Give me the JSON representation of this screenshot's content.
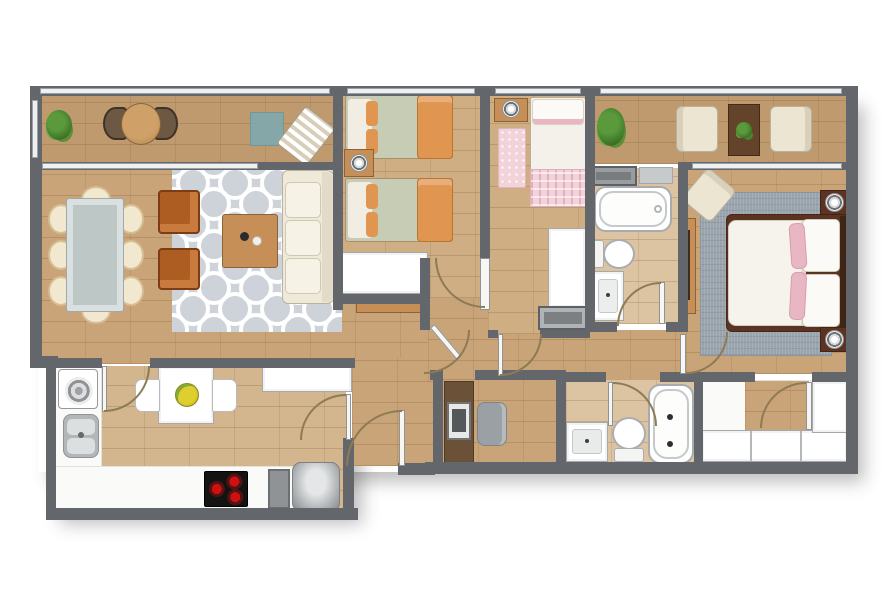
{
  "palette": {
    "wall": "#63676b",
    "wall_mid": "#8f9396",
    "window_glass": "#eef0f2",
    "window_frame": "#9aa0a4",
    "floor_living": "#c9a478",
    "floor_balcony": "#bf9a6e",
    "floor_bedroom": "#cfae84",
    "floor_bath": "#dcc4a2",
    "floor_kitchen_wood": "#d3b58e",
    "floor_white": "#fafaf8",
    "rug_trellis_bg": "#cdd3d9",
    "rug_trellis_line": "#ffffff",
    "rug_master": "#9aa4ac",
    "rug_pink": "#f3d3da",
    "sofa_cream": "#efe9d9",
    "cushion_cream": "#f6f2e6",
    "armchair_orange": "#ad5c22",
    "armchair_orange_light": "#c97a3d",
    "dining_glass": "#bcc7c6",
    "wicker": "#f2e7cf",
    "wicker_edge": "#d6bd92",
    "wood_furniture": "#c68f57",
    "wood_dark": "#8c6238",
    "bed_sage": "#c7ccb4",
    "bed_orange": "#e09550",
    "pink_mid": "#e9b7c3",
    "teal_mat": "#7fa9ae",
    "cream_chair": "#ece5d2",
    "table_darkwood": "#63432a",
    "desk_brown": "#6a5138",
    "steel": "#b7babc",
    "appliance_black": "#131313",
    "burner_red": "#cf1010",
    "fruit_yellow": "#decf2e",
    "plant_green": "#5a9a3c",
    "plant_dark": "#3c7526",
    "white_furniture": "#ffffff",
    "master_bedframe": "#5c3322",
    "door_arc": "#8d7b55",
    "door_leaf": "#f7f6f2"
  },
  "rooms": [
    "balcony",
    "living-room",
    "dining-area",
    "kitchen",
    "entry",
    "kids-bedroom",
    "bedroom",
    "terrace",
    "bathroom",
    "hallway",
    "master-bedroom",
    "study-nook",
    "second-bathroom",
    "walk-in-closet"
  ],
  "furniture": [
    "outdoor-plant",
    "bistro-table",
    "bistro-chairs",
    "teal-mat",
    "lounge-chair",
    "dining-table",
    "wicker-chairs",
    "orange-armchairs",
    "trellis-rug",
    "coffee-table",
    "sofa",
    "sideboard",
    "washing-machine",
    "kitchen-sink",
    "kitchen-counter",
    "cooktop",
    "refrigerator",
    "breakfast-table",
    "fruit-plate",
    "single-bed",
    "nightstand",
    "table-lamp",
    "wardrobe",
    "wall-shelf",
    "pink-rug",
    "gray-cabinet",
    "terrace-armchairs",
    "terrace-side-table",
    "bathtub",
    "toilet",
    "vanity-sink",
    "master-bed",
    "master-rug",
    "accent-armchair",
    "dresser-console",
    "desk",
    "monitor",
    "desk-chair",
    "closet-wardrobes"
  ]
}
